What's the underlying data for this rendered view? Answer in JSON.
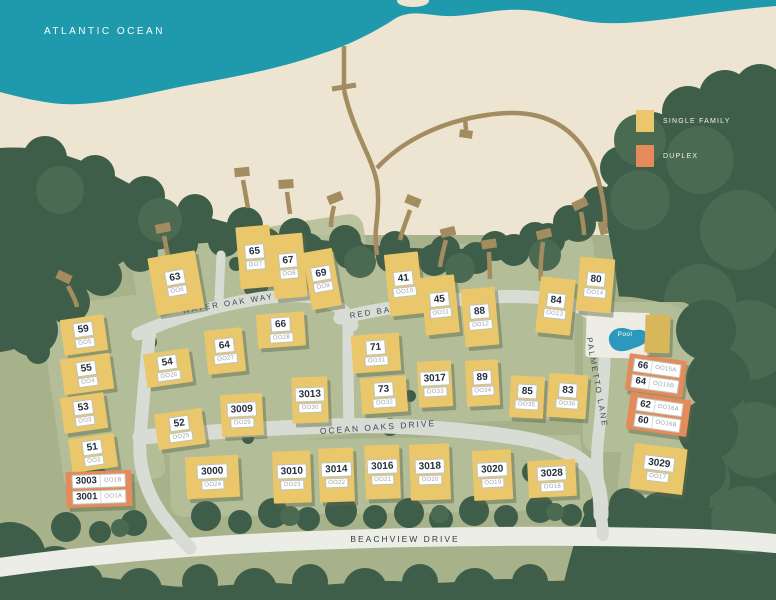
{
  "map": {
    "ocean_label": "ATLANTIC OCEAN",
    "pool_label": "Pool"
  },
  "legend": {
    "items": [
      {
        "label": "SINGLE FAMILY",
        "color": "#E9C76A",
        "type": "single_family"
      },
      {
        "label": "DUPLEX",
        "color": "#E58A5B",
        "type": "duplex"
      }
    ]
  },
  "streets": [
    {
      "id": "water-oak-way",
      "name": "WATER OAK WAY"
    },
    {
      "id": "red-bay-lane",
      "name": "RED BAY LANE"
    },
    {
      "id": "ocean-oaks-drive",
      "name": "OCEAN OAKS DRIVE"
    },
    {
      "id": "palmetto-lane",
      "name": "PALMETTO LANE"
    },
    {
      "id": "beachview-drive",
      "name": "BEACHVIEW DRIVE"
    }
  ],
  "colors": {
    "ocean": "#1F9AAD",
    "sand": "#EDE5D1",
    "forest_dark": "#3F5E49",
    "forest_mid": "#4A6A52",
    "ground": "#A7B28A",
    "ground_light": "#B5BF99",
    "road": "#D9DCD4",
    "road_main": "#EBEDE6",
    "boardwalk": "#A38C60",
    "pool": "#2D98BD",
    "single_family": "#E9C76A",
    "duplex": "#E58A5B"
  },
  "buildings": [
    {
      "number": "59",
      "code": "OO5",
      "type": "single",
      "x": 62,
      "y": 317,
      "w": 44,
      "h": 36,
      "rot": -8
    },
    {
      "number": "55",
      "code": "OO4",
      "type": "single",
      "x": 62,
      "y": 356,
      "w": 50,
      "h": 36,
      "rot": -8
    },
    {
      "number": "53",
      "code": "OO3",
      "type": "single",
      "x": 62,
      "y": 395,
      "w": 44,
      "h": 36,
      "rot": -8
    },
    {
      "number": "51",
      "code": "OO2",
      "type": "single",
      "x": 70,
      "y": 436,
      "w": 46,
      "h": 34,
      "rot": -8
    },
    {
      "type": "duplex",
      "units": [
        {
          "number": "3003",
          "code": "OO1B"
        },
        {
          "number": "3001",
          "code": "OO1A"
        }
      ],
      "x": 66,
      "y": 471,
      "w": 66,
      "h": 36,
      "rot": -2
    },
    {
      "number": "63",
      "code": "OO6",
      "type": "single",
      "x": 152,
      "y": 254,
      "w": 48,
      "h": 58,
      "rot": -10
    },
    {
      "number": "65",
      "code": "OO7",
      "type": "single",
      "x": 238,
      "y": 226,
      "w": 34,
      "h": 62,
      "rot": -5
    },
    {
      "number": "67",
      "code": "OO8",
      "type": "single",
      "x": 272,
      "y": 234,
      "w": 33,
      "h": 64,
      "rot": -5
    },
    {
      "number": "69",
      "code": "OO9",
      "type": "single",
      "x": 307,
      "y": 250,
      "w": 30,
      "h": 58,
      "rot": -10
    },
    {
      "number": "54",
      "code": "OO26",
      "type": "single",
      "x": 145,
      "y": 351,
      "w": 46,
      "h": 34,
      "rot": -8
    },
    {
      "number": "64",
      "code": "OO27",
      "type": "single",
      "x": 206,
      "y": 329,
      "w": 38,
      "h": 44,
      "rot": -6
    },
    {
      "number": "66",
      "code": "OO28",
      "type": "single",
      "x": 257,
      "y": 313,
      "w": 48,
      "h": 34,
      "rot": -4
    },
    {
      "number": "52",
      "code": "OO25",
      "type": "single",
      "x": 156,
      "y": 411,
      "w": 48,
      "h": 36,
      "rot": -8
    },
    {
      "number": "3009",
      "code": "OO29",
      "type": "single",
      "x": 221,
      "y": 394,
      "w": 42,
      "h": 42,
      "rot": -3
    },
    {
      "number": "3013",
      "code": "OO30",
      "type": "single",
      "x": 292,
      "y": 377,
      "w": 36,
      "h": 46,
      "rot": -2
    },
    {
      "number": "41",
      "code": "OO10",
      "type": "single",
      "x": 387,
      "y": 253,
      "w": 34,
      "h": 62,
      "rot": -6
    },
    {
      "number": "45",
      "code": "OO11",
      "type": "single",
      "x": 423,
      "y": 276,
      "w": 34,
      "h": 58,
      "rot": -6
    },
    {
      "number": "88",
      "code": "OO12",
      "type": "single",
      "x": 463,
      "y": 288,
      "w": 34,
      "h": 58,
      "rot": -5
    },
    {
      "number": "84",
      "code": "OO13",
      "type": "single",
      "x": 538,
      "y": 278,
      "w": 35,
      "h": 56,
      "rot": 6
    },
    {
      "number": "80",
      "code": "OO14",
      "type": "single",
      "x": 578,
      "y": 258,
      "w": 35,
      "h": 54,
      "rot": 5
    },
    {
      "number": "71",
      "code": "OO31",
      "type": "single",
      "x": 352,
      "y": 334,
      "w": 48,
      "h": 38,
      "rot": -4
    },
    {
      "number": "73",
      "code": "OO32",
      "type": "single",
      "x": 361,
      "y": 377,
      "w": 46,
      "h": 36,
      "rot": -4
    },
    {
      "number": "3017",
      "code": "OO33",
      "type": "single",
      "x": 418,
      "y": 361,
      "w": 34,
      "h": 46,
      "rot": -3
    },
    {
      "number": "89",
      "code": "OO34",
      "type": "single",
      "x": 466,
      "y": 360,
      "w": 33,
      "h": 46,
      "rot": -3
    },
    {
      "number": "85",
      "code": "OO35",
      "type": "single",
      "x": 510,
      "y": 376,
      "w": 34,
      "h": 42,
      "rot": 3
    },
    {
      "number": "83",
      "code": "OO36",
      "type": "single",
      "x": 548,
      "y": 374,
      "w": 39,
      "h": 44,
      "rot": 4
    },
    {
      "number": "3000",
      "code": "OO24",
      "type": "single",
      "x": 186,
      "y": 456,
      "w": 53,
      "h": 42,
      "rot": -3
    },
    {
      "number": "3010",
      "code": "OO23",
      "type": "single",
      "x": 273,
      "y": 451,
      "w": 38,
      "h": 52,
      "rot": -2
    },
    {
      "number": "3014",
      "code": "OO22",
      "type": "single",
      "x": 319,
      "y": 448,
      "w": 35,
      "h": 54,
      "rot": -2
    },
    {
      "number": "3016",
      "code": "OO21",
      "type": "single",
      "x": 365,
      "y": 445,
      "w": 35,
      "h": 54,
      "rot": -2
    },
    {
      "number": "3018",
      "code": "OO20",
      "type": "single",
      "x": 410,
      "y": 444,
      "w": 40,
      "h": 56,
      "rot": -2
    },
    {
      "number": "3020",
      "code": "OO19",
      "type": "single",
      "x": 473,
      "y": 450,
      "w": 39,
      "h": 50,
      "rot": -3
    },
    {
      "number": "3028",
      "code": "OO18",
      "type": "single",
      "x": 528,
      "y": 460,
      "w": 48,
      "h": 37,
      "rot": -3
    },
    {
      "number": "3029",
      "code": "OO17",
      "type": "single",
      "x": 632,
      "y": 446,
      "w": 53,
      "h": 46,
      "rot": 7
    },
    {
      "type": "duplex",
      "units": [
        {
          "number": "66",
          "code": "OO15A"
        },
        {
          "number": "64",
          "code": "OO15B"
        }
      ],
      "x": 627,
      "y": 357,
      "w": 58,
      "h": 37,
      "rot": 8
    },
    {
      "type": "duplex",
      "units": [
        {
          "number": "62",
          "code": "OO16A"
        },
        {
          "number": "60",
          "code": "OO16B"
        }
      ],
      "x": 628,
      "y": 396,
      "w": 61,
      "h": 37,
      "rot": 8
    },
    {
      "type": "clubhouse",
      "x": 645,
      "y": 315,
      "w": 25,
      "h": 38,
      "rot": 2
    }
  ]
}
